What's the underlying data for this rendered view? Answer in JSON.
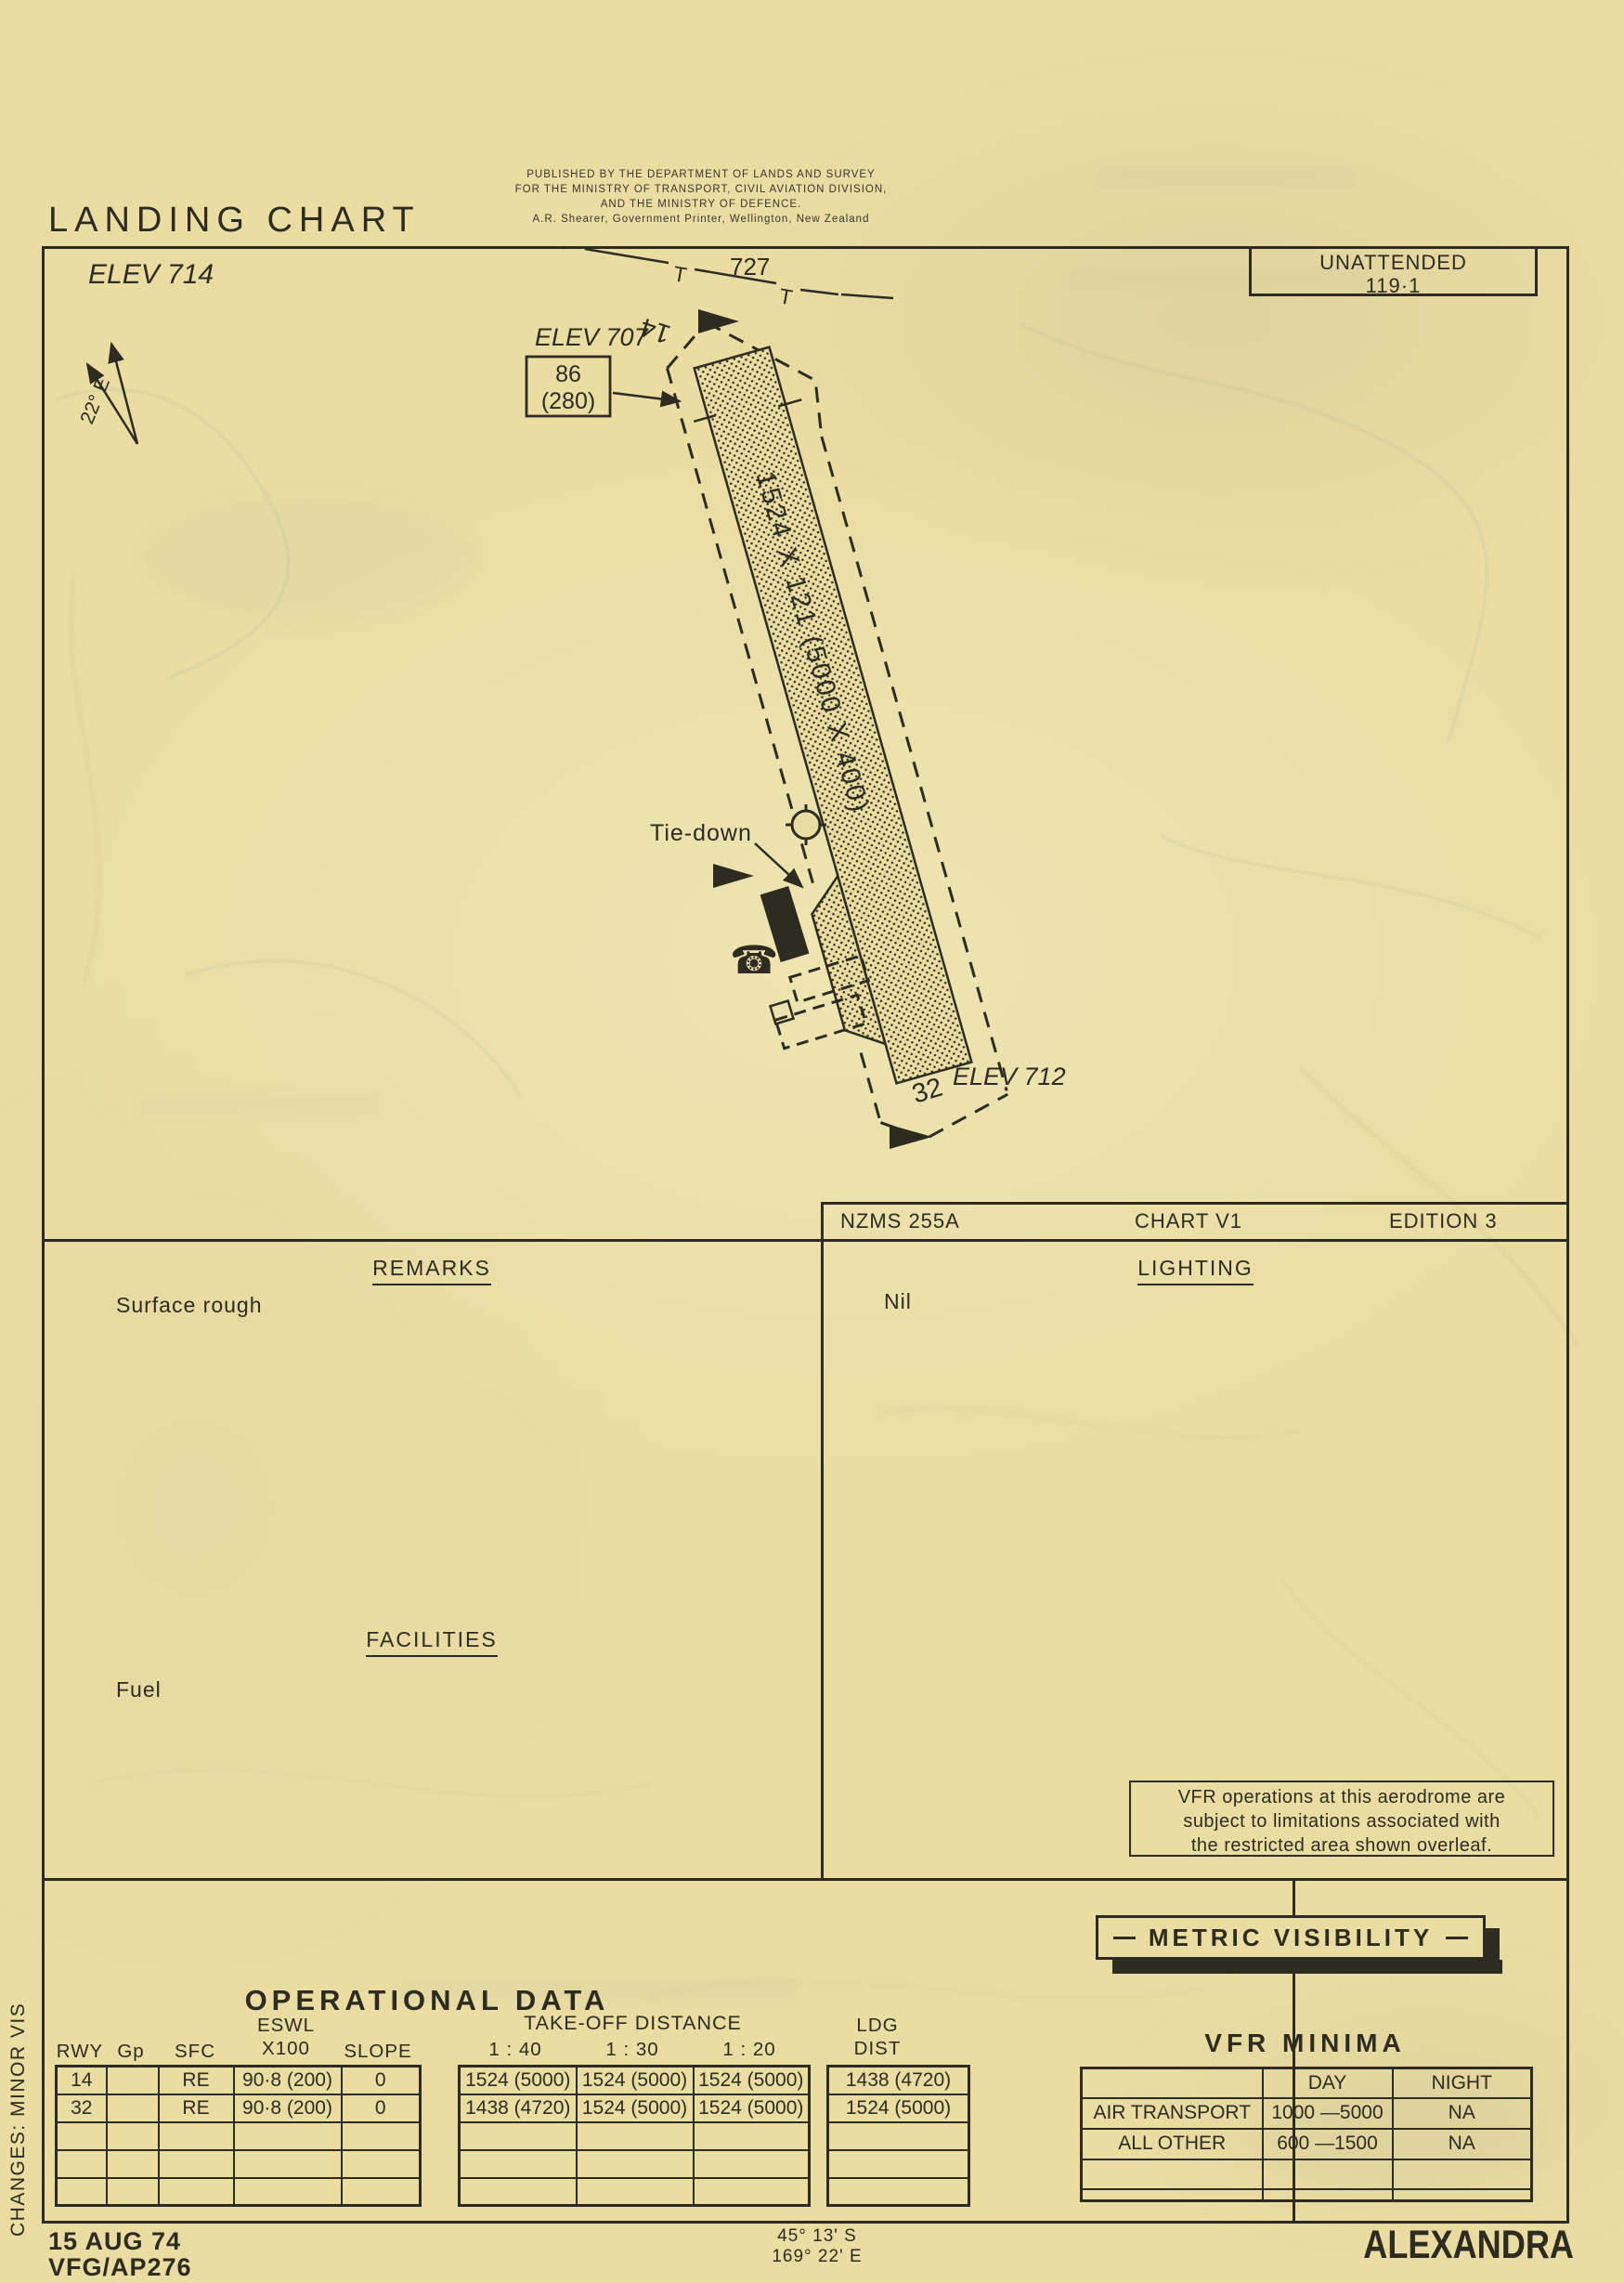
{
  "header": {
    "title": "LANDING CHART",
    "publisher": [
      "PUBLISHED BY THE DEPARTMENT OF LANDS AND SURVEY",
      "FOR THE MINISTRY OF TRANSPORT, CIVIL AVIATION DIVISION,",
      "AND THE MINISTRY OF DEFENCE.",
      "A.R. Shearer, Government Printer, Wellington, New Zealand"
    ],
    "elevation": "ELEV 714",
    "attendance": "UNATTENDED",
    "frequency": "119·1",
    "magnetic_variation": "22° E"
  },
  "map": {
    "spot_height": "727",
    "powerline_symbol": "T",
    "rwy_end_14": "14",
    "rwy_end_32": "32",
    "elev_14_end": "ELEV 707",
    "elev_32_end": "ELEV 712",
    "circuit_alt": "86",
    "circuit_alt_agl": "(280)",
    "runway_dimensions": "1524 X 121 (5000 X 400)",
    "tiedown": "Tie-down",
    "phone_icon": "☎"
  },
  "chart_info": {
    "series": "NZMS 255A",
    "chart_no": "CHART V1",
    "edition": "EDITION 3"
  },
  "remarks": {
    "heading": "REMARKS",
    "text": "Surface rough"
  },
  "lighting": {
    "heading": "LIGHTING",
    "text": "Nil"
  },
  "facilities": {
    "heading": "FACILITIES",
    "text": "Fuel"
  },
  "vfr_note": [
    "VFR operations at this aerodrome are",
    "subject to limitations associated with",
    "the restricted area shown overleaf."
  ],
  "operational_data": {
    "title": "OPERATIONAL DATA",
    "col_rwy": "RWY",
    "col_gp": "Gp",
    "col_sfc": "SFC",
    "col_eswl_1": "ESWL",
    "col_eswl_2": "X100",
    "col_slope": "SLOPE",
    "col_takeoff": "TAKE-OFF DISTANCE",
    "col_40": "1 : 40",
    "col_30": "1 : 30",
    "col_20": "1 : 20",
    "col_ldg_1": "LDG",
    "col_ldg_2": "DIST",
    "rows": [
      {
        "rwy": "14",
        "gp": "",
        "sfc": "RE",
        "eswl": "90·8 (200)",
        "slope": "0",
        "to_40": "1524 (5000)",
        "to_30": "1524 (5000)",
        "to_20": "1524 (5000)",
        "ldg": "1438 (4720)"
      },
      {
        "rwy": "32",
        "gp": "",
        "sfc": "RE",
        "eswl": "90·8 (200)",
        "slope": "0",
        "to_40": "1438 (4720)",
        "to_30": "1524 (5000)",
        "to_20": "1524 (5000)",
        "ldg": "1524 (5000)"
      }
    ]
  },
  "metric_visibility": {
    "title": "METRIC VISIBILITY"
  },
  "vfr_minima": {
    "title": "VFR MINIMA",
    "col_day": "DAY",
    "col_night": "NIGHT",
    "rows": [
      {
        "category": "AIR TRANSPORT",
        "day": "1000 —5000",
        "night": "NA"
      },
      {
        "category": "ALL OTHER",
        "day": "600 —1500",
        "night": "NA"
      }
    ]
  },
  "footer": {
    "date": "15 AUG 74",
    "reference": "VFG/AP276",
    "latitude": "45° 13' S",
    "longitude": "169° 22' E",
    "aerodrome": "ALEXANDRA",
    "changes": "CHANGES: MINOR VIS"
  }
}
